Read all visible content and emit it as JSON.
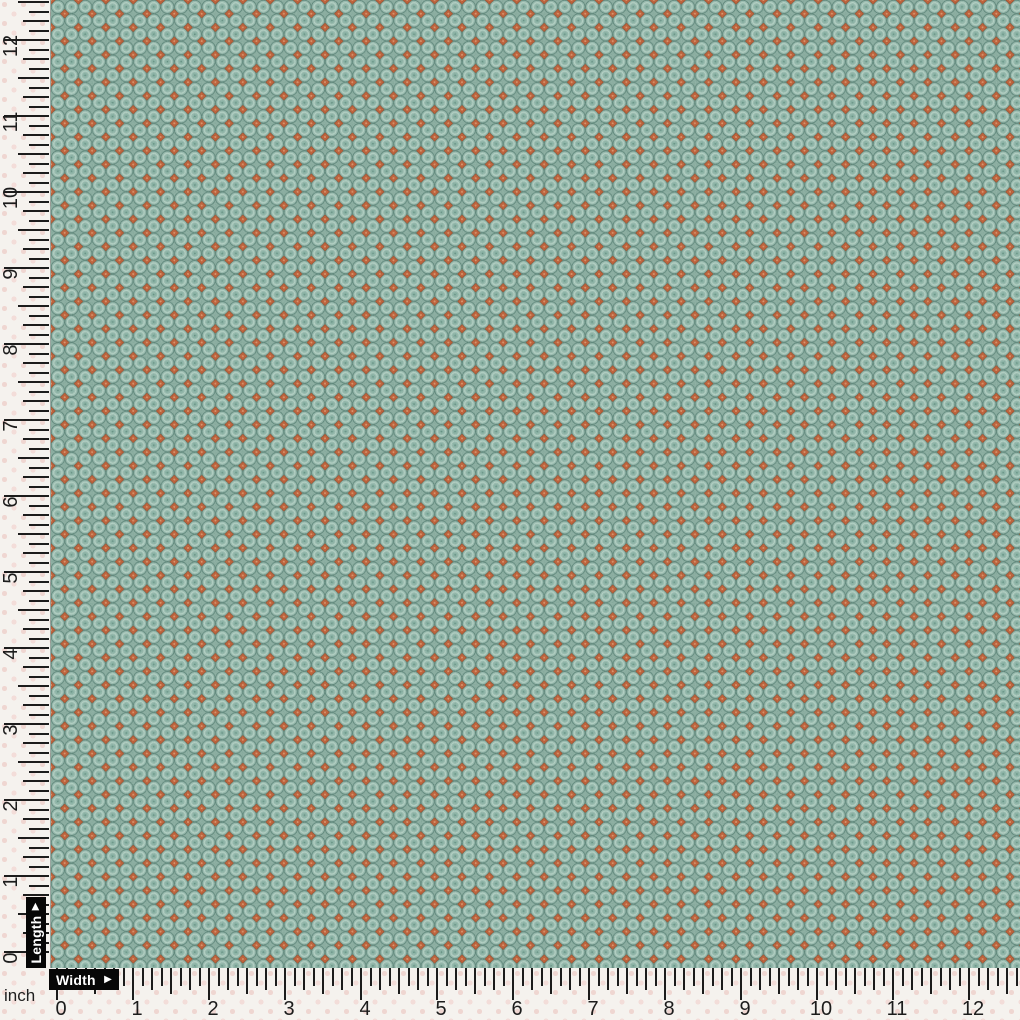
{
  "fabric": {
    "description": "Teal seafoam fabric swatch with packed circle medallions and rust-orange diamond dots in a checkerboard between them"
  },
  "rulers": {
    "unit_label": "inch",
    "numbers": [
      "0",
      "1",
      "2",
      "3",
      "4",
      "5",
      "6",
      "7",
      "8",
      "9",
      "10",
      "11",
      "12"
    ],
    "horizontal": {
      "label": "Width",
      "arrow_icon": "▶"
    },
    "vertical": {
      "label": "Length",
      "arrow_icon": "▶"
    },
    "geometry": {
      "px_per_inch": 76,
      "subdivisions_per_inch": 8,
      "horizontal": {
        "origin_x": 57,
        "top_y": 968,
        "max_x": 1019,
        "number_top": 1000,
        "tick_lengths": {
          "inch": 32,
          "half": 26,
          "quarter": 22,
          "eighth": 18
        }
      },
      "vertical": {
        "origin_y": 952,
        "right_x": 49,
        "number_center_x": 11,
        "number_offset": 6,
        "tick_lengths": {
          "inch": 45,
          "half": 31,
          "quarter": 26,
          "eighth": 20
        }
      }
    }
  },
  "colors": {
    "tick": "#1c1c1c",
    "label_bg": "#070707",
    "label_text": "#ffffff",
    "background_base": "#f5f2ee",
    "background_dot": "#efd6d1",
    "fabric_base": "#6d9a8c",
    "fabric_circle": "#8db1a4",
    "fabric_circle_light": "#a9c9bb",
    "fabric_circle_dark": "#567f72",
    "fabric_dot_orange": "#b5552f"
  }
}
